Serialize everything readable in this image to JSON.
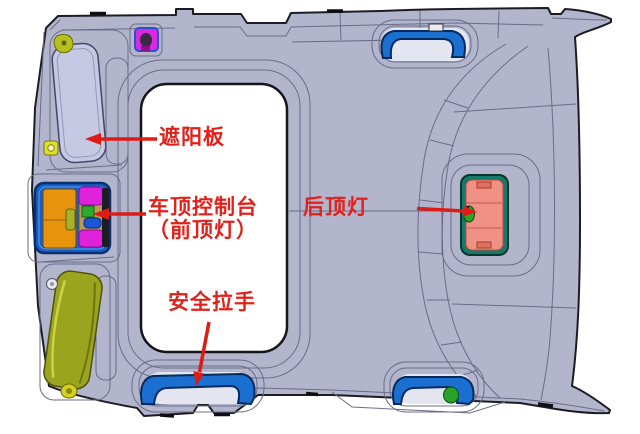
{
  "diagram": {
    "labels": {
      "sun_visor": "遮阳板",
      "roof_console_line1": "车顶控制台",
      "roof_console_line2": "（前顶灯）",
      "rear_dome_light": "后顶灯",
      "grab_handle": "安全拉手"
    },
    "colors": {
      "annotation_red": "#e2211a",
      "headliner_body": "#b3b5cc",
      "outline_dark": "#1c1c24",
      "contour_line": "#6a6d88",
      "handle_blue": "#1a6fd0",
      "console_frame_blue": "#1560c8",
      "console_orange": "#e8930c",
      "console_magenta": "#e122dd",
      "front_dome_green": "#2faa2f",
      "rear_lamp_lens_salmon": "#ef9184",
      "rear_lamp_frame_teal": "#157a6b",
      "rear_clip_green": "#2da22d",
      "visor_olive": "#9aa41f",
      "visor_lavender": "#c6c9e4",
      "clip_yellow": "#dede2e",
      "sunroof_opening_white": "#ffffff"
    },
    "parts": [
      {
        "name": "sun-visor-driver"
      },
      {
        "name": "sun-visor-rear"
      },
      {
        "name": "roof-console-with-front-dome-light"
      },
      {
        "name": "rear-dome-light"
      },
      {
        "name": "grab-handle-front-right"
      },
      {
        "name": "grab-handle-rear-center"
      },
      {
        "name": "grab-handle-rear-right"
      },
      {
        "name": "sunroof-opening"
      },
      {
        "name": "roof-clip"
      }
    ],
    "arrows": [
      {
        "points_to": "sun-visor-driver",
        "direction": "left"
      },
      {
        "points_to": "roof-console-with-front-dome-light",
        "direction": "left"
      },
      {
        "points_to": "rear-dome-light",
        "direction": "right"
      },
      {
        "points_to": "grab-handle-rear-center",
        "direction": "down"
      }
    ]
  }
}
